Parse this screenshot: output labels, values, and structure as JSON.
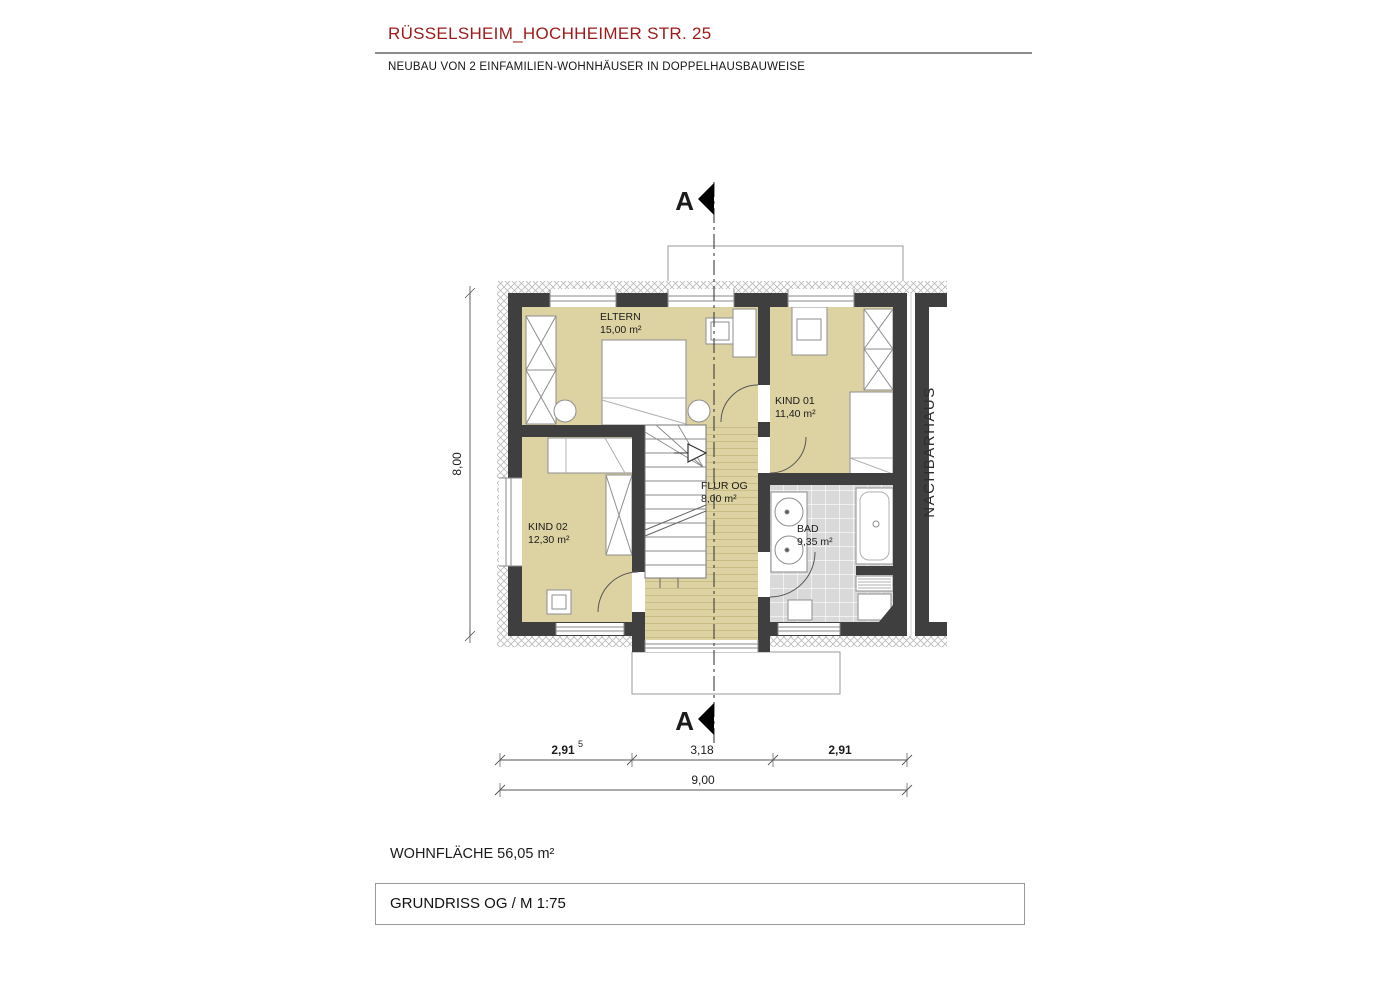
{
  "header": {
    "title": "RÜSSELSHEIM_HOCHHEIMER STR. 25",
    "subtitle": "NEUBAU VON 2 EINFAMILIEN-WOHNHÄUSER IN DOPPELHAUSBAUWEISE"
  },
  "plan": {
    "rooms": [
      {
        "name": "ELTERN",
        "area": "15,00 m²"
      },
      {
        "name": "KIND 01",
        "area": "11,40 m²"
      },
      {
        "name": "KIND 02",
        "area": "12,30 m²"
      },
      {
        "name": "FLUR OG",
        "area": "8,00 m²"
      },
      {
        "name": "BAD",
        "area": "9,35 m²"
      }
    ],
    "neighbor_label": "NACHBARHAUS",
    "section_label": "A",
    "dimensions": {
      "seg_left": "2,91",
      "seg_left_sup": "5",
      "seg_mid": "3,18",
      "seg_right": "2,91",
      "total_width": "9,00",
      "total_height": "8,00"
    },
    "colors": {
      "wall": "#3f3f3f",
      "room_fill": "#ddd3a2",
      "tile_floor": "#d9d9d9",
      "accent_red": "#9e1a1a"
    }
  },
  "footer": {
    "living_area": "WOHNFLÄCHE 56,05 m²",
    "drawing_title": "GRUNDRISS OG / M 1:75"
  }
}
